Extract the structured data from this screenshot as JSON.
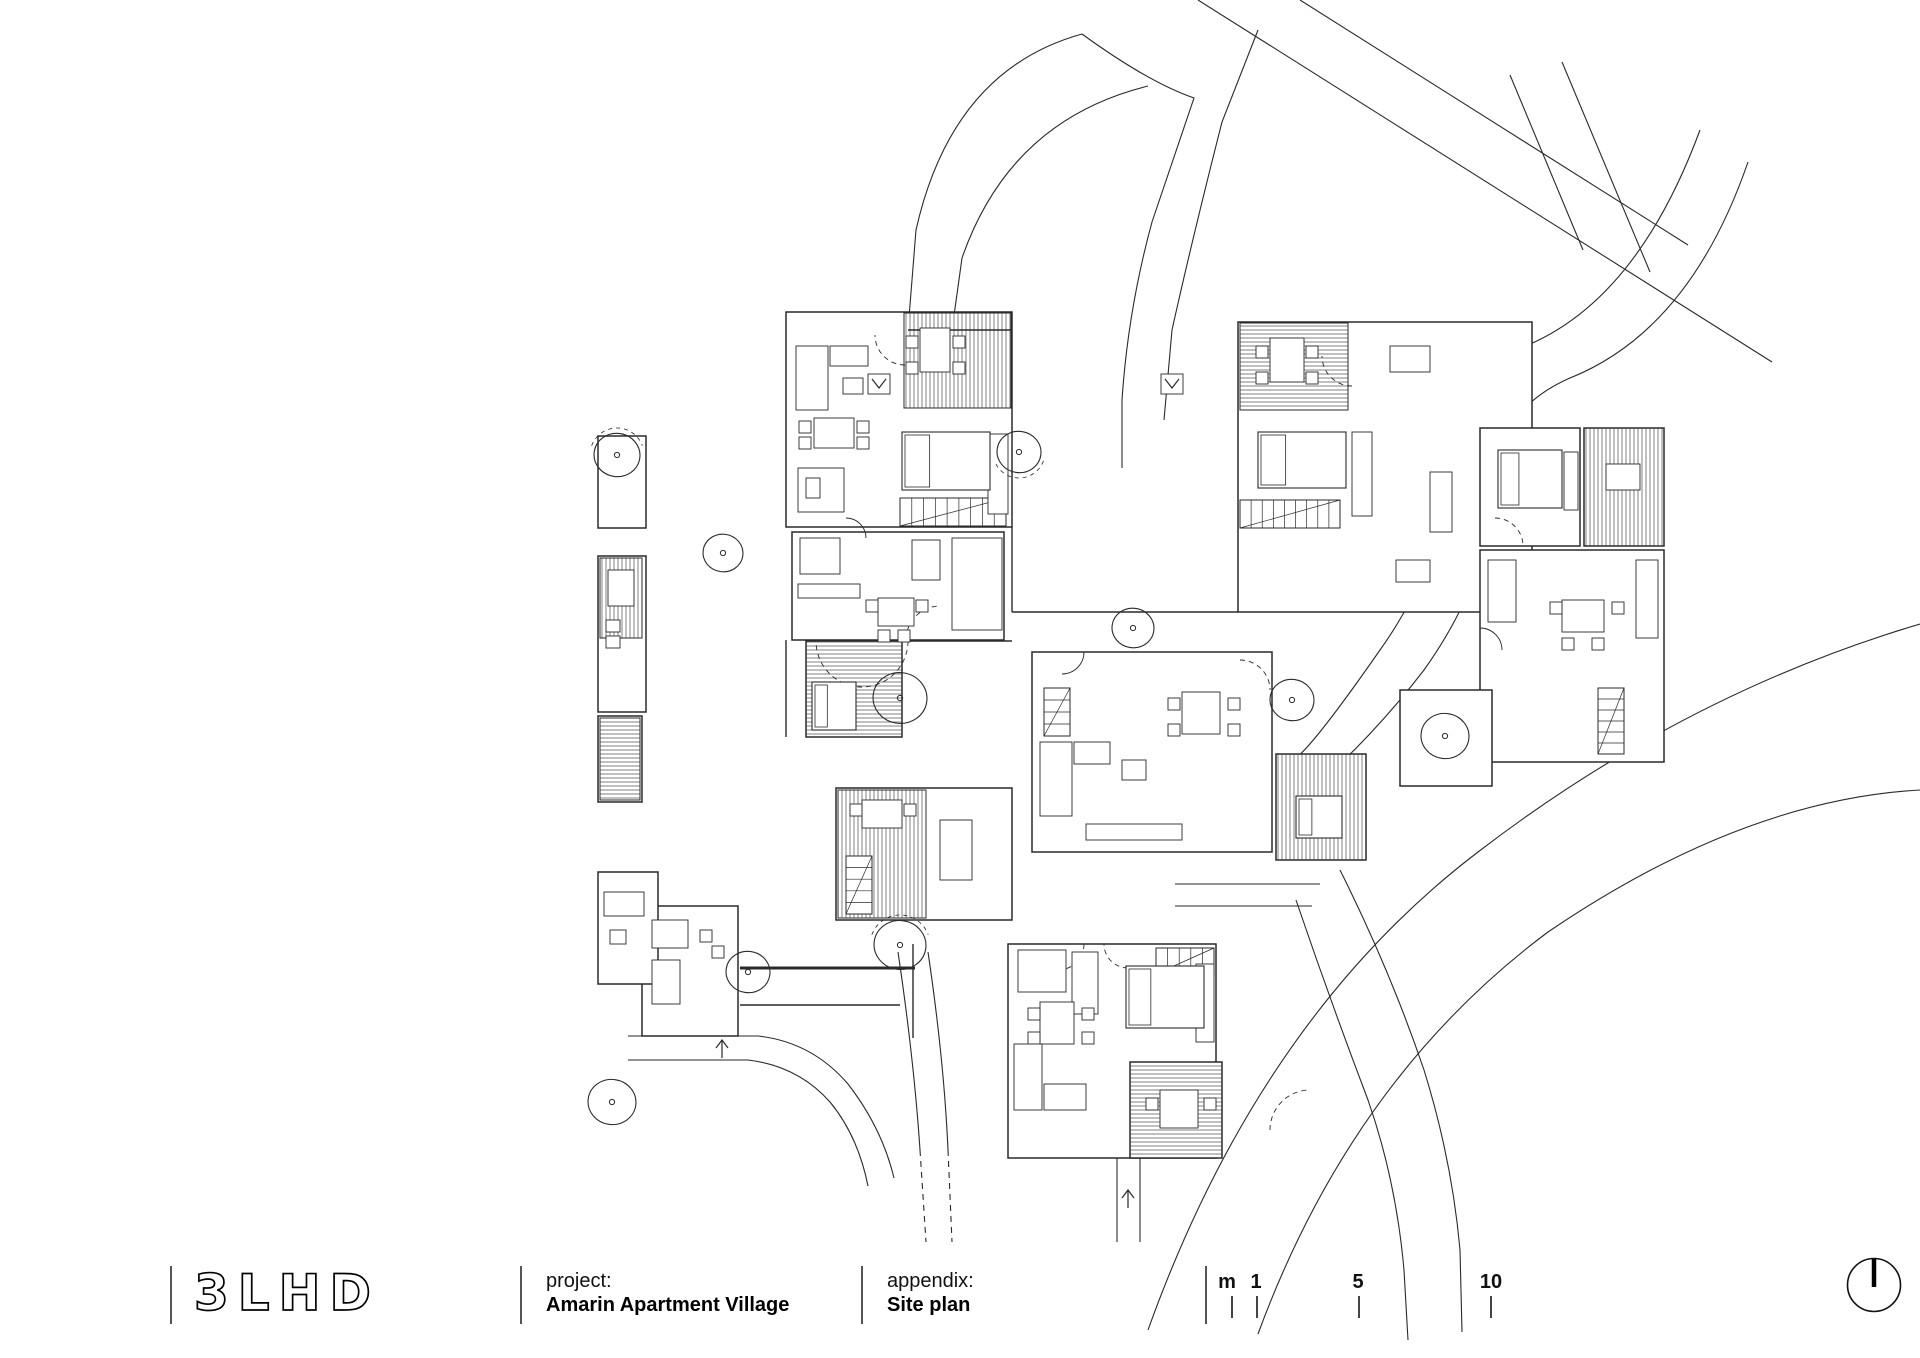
{
  "titlebar": {
    "logo_text": "3LHD",
    "project_label": "project:",
    "project_value": "Amarin Apartment Village",
    "appendix_label": "appendix:",
    "appendix_value": "Site plan",
    "scale_unit": "m",
    "scale_ticks": [
      "1",
      "5",
      "10"
    ]
  },
  "drawing": {
    "ink": "#2a2a2a",
    "roads": [
      {
        "d": "M 1082 34 Q 1148 82 1194 98 L 1152 222 Q 1128 310 1122 400 L 1122 468"
      },
      {
        "d": "M 1258 30 L 1222 122 Q 1192 240 1172 330 L 1164 420"
      },
      {
        "d": "M 1082 34 Q 952 70 916 230 L 908 330"
      },
      {
        "d": "M 1148 86 Q 1010 120 962 258 L 952 330"
      },
      {
        "d": "M 1198 0 L 1772 362"
      },
      {
        "d": "M 1300 0 L 1688 245"
      },
      {
        "d": "M 1510 75 L 1583 250"
      },
      {
        "d": "M 1562 62 L 1650 272"
      },
      {
        "d": "M 1700 130 Q 1638 298 1528 345 Q 1448 380 1446 470 Q 1444 560 1380 650 Q 1316 742 1296 758"
      },
      {
        "d": "M 1748 162 Q 1690 330 1570 378 Q 1492 412 1490 498 Q 1488 580 1424 670 Q 1384 722 1340 764 Q 1310 790 1296 816"
      },
      {
        "d": "M 1296 758 Q 1310 810 1318 860"
      },
      {
        "d": "M 1148 1330 Q 1260 1018 1478 852 Q 1684 694 1920 624"
      },
      {
        "d": "M 1258 1334 Q 1352 1078 1548 932 Q 1742 800 1920 790"
      },
      {
        "d": "M 1296 900 Q 1330 1000 1368 1100 Q 1396 1180 1404 1270 L 1408 1340"
      },
      {
        "d": "M 1340 870 Q 1390 970 1424 1070 Q 1452 1160 1460 1250 L 1462 1332"
      },
      {
        "d": "M 1175 884 L 1320 884"
      },
      {
        "d": "M 1175 906 L 1312 906"
      },
      {
        "d": "M 898 952 Q 914 1060 920 1150"
      },
      {
        "d": "M 920 1150 L 926 1242",
        "dash": true
      },
      {
        "d": "M 928 952 Q 944 1060 948 1150"
      },
      {
        "d": "M 948 1150 L 952 1242",
        "dash": true
      },
      {
        "d": "M 1117 1158 L 1117 1242"
      },
      {
        "d": "M 1140 1158 L 1140 1242"
      },
      {
        "d": "M 628 1036 L 758 1036 Q 812 1042 848 1084 Q 882 1128 894 1178"
      },
      {
        "d": "M 628 1060 L 748 1060 Q 798 1066 830 1102 Q 858 1136 868 1186"
      }
    ],
    "units": [
      [
        786,
        312,
        226,
        215
      ],
      [
        792,
        532,
        212,
        108
      ],
      [
        806,
        641,
        96,
        96
      ],
      [
        1238,
        322,
        294,
        290
      ],
      [
        1480,
        428,
        100,
        118
      ],
      [
        1584,
        428,
        80,
        118
      ],
      [
        1480,
        550,
        184,
        212
      ],
      [
        1032,
        652,
        240,
        200
      ],
      [
        1276,
        754,
        90,
        106
      ],
      [
        836,
        788,
        176,
        132
      ],
      [
        1008,
        944,
        208,
        214
      ],
      [
        1130,
        1062,
        92,
        96
      ],
      [
        642,
        906,
        96,
        130
      ],
      [
        598,
        436,
        48,
        92
      ],
      [
        598,
        556,
        48,
        156
      ],
      [
        598,
        716,
        44,
        86
      ],
      [
        598,
        872,
        60,
        112
      ],
      [
        1400,
        690,
        92,
        96
      ]
    ],
    "hatches": [
      [
        904,
        313,
        107,
        95,
        "v"
      ],
      [
        1240,
        323,
        108,
        87,
        "h"
      ],
      [
        806,
        641,
        96,
        96,
        "h"
      ],
      [
        1584,
        428,
        80,
        118,
        "v"
      ],
      [
        838,
        790,
        88,
        128,
        "v"
      ],
      [
        1276,
        754,
        90,
        106,
        "v"
      ],
      [
        1130,
        1062,
        92,
        96,
        "h"
      ],
      [
        600,
        558,
        42,
        80,
        "v"
      ],
      [
        600,
        718,
        40,
        82,
        "h"
      ]
    ],
    "walls": [
      [
        1012,
        527,
        1012,
        612,
        1.4
      ],
      [
        1012,
        612,
        1238,
        612,
        1.4
      ],
      [
        786,
        640,
        786,
        737,
        1.4
      ],
      [
        902,
        641,
        1012,
        641,
        1.4
      ],
      [
        908,
        330,
        1012,
        330,
        1.4
      ],
      [
        740,
        968,
        915,
        968,
        3
      ],
      [
        740,
        1005,
        900,
        1005,
        1.4
      ],
      [
        913,
        944,
        913,
        1038,
        1.4
      ]
    ],
    "furniture": [
      [
        796,
        346,
        32,
        64
      ],
      [
        830,
        346,
        38,
        20
      ],
      [
        843,
        378,
        20,
        16
      ],
      [
        814,
        418,
        40,
        30
      ],
      [
        799,
        421,
        12,
        12
      ],
      [
        799,
        437,
        12,
        12
      ],
      [
        857,
        421,
        12,
        12
      ],
      [
        857,
        437,
        12,
        12
      ],
      [
        920,
        328,
        30,
        44
      ],
      [
        906,
        336,
        12,
        12
      ],
      [
        953,
        336,
        12,
        12
      ],
      [
        906,
        362,
        12,
        12
      ],
      [
        953,
        362,
        12,
        12
      ],
      [
        988,
        434,
        20,
        80
      ],
      [
        798,
        468,
        46,
        44
      ],
      [
        806,
        478,
        14,
        20
      ],
      [
        800,
        538,
        40,
        36
      ],
      [
        798,
        584,
        62,
        14
      ],
      [
        878,
        598,
        36,
        28
      ],
      [
        866,
        600,
        12,
        12
      ],
      [
        916,
        600,
        12,
        12
      ],
      [
        878,
        630,
        12,
        12
      ],
      [
        898,
        630,
        12,
        12
      ],
      [
        912,
        540,
        28,
        40
      ],
      [
        952,
        538,
        50,
        92
      ],
      [
        862,
        800,
        40,
        28
      ],
      [
        850,
        804,
        12,
        12
      ],
      [
        904,
        804,
        12,
        12
      ],
      [
        940,
        820,
        32,
        60
      ],
      [
        1270,
        338,
        34,
        44
      ],
      [
        1256,
        346,
        12,
        12
      ],
      [
        1306,
        346,
        12,
        12
      ],
      [
        1256,
        372,
        12,
        12
      ],
      [
        1306,
        372,
        12,
        12
      ],
      [
        1352,
        432,
        20,
        84
      ],
      [
        1390,
        346,
        40,
        26
      ],
      [
        1430,
        472,
        22,
        60
      ],
      [
        1396,
        560,
        34,
        22
      ],
      [
        1606,
        464,
        34,
        26
      ],
      [
        1488,
        560,
        28,
        62
      ],
      [
        1562,
        600,
        42,
        32
      ],
      [
        1550,
        602,
        12,
        12
      ],
      [
        1612,
        602,
        12,
        12
      ],
      [
        1562,
        638,
        12,
        12
      ],
      [
        1592,
        638,
        12,
        12
      ],
      [
        1636,
        560,
        22,
        78
      ],
      [
        1564,
        452,
        14,
        58
      ],
      [
        1040,
        742,
        32,
        74
      ],
      [
        1074,
        742,
        36,
        22
      ],
      [
        1182,
        692,
        38,
        42
      ],
      [
        1168,
        698,
        12,
        12
      ],
      [
        1228,
        698,
        12,
        12
      ],
      [
        1168,
        724,
        12,
        12
      ],
      [
        1228,
        724,
        12,
        12
      ],
      [
        1086,
        824,
        96,
        16
      ],
      [
        1122,
        760,
        24,
        20
      ],
      [
        1018,
        950,
        48,
        42
      ],
      [
        1072,
        952,
        26,
        62
      ],
      [
        1040,
        1002,
        34,
        42
      ],
      [
        1028,
        1008,
        12,
        12
      ],
      [
        1082,
        1008,
        12,
        12
      ],
      [
        1028,
        1032,
        12,
        12
      ],
      [
        1082,
        1032,
        12,
        12
      ],
      [
        1014,
        1044,
        28,
        66
      ],
      [
        1044,
        1084,
        42,
        26
      ],
      [
        1196,
        964,
        18,
        78
      ],
      [
        1160,
        1090,
        38,
        38
      ],
      [
        1146,
        1098,
        12,
        12
      ],
      [
        1204,
        1098,
        12,
        12
      ],
      [
        652,
        920,
        36,
        28
      ],
      [
        652,
        960,
        28,
        44
      ],
      [
        700,
        930,
        12,
        12
      ],
      [
        712,
        946,
        12,
        12
      ],
      [
        608,
        570,
        26,
        36
      ],
      [
        606,
        620,
        14,
        12
      ],
      [
        606,
        636,
        14,
        12
      ],
      [
        604,
        892,
        40,
        24
      ],
      [
        610,
        930,
        16,
        14
      ],
      [
        868,
        374,
        22,
        20
      ],
      [
        1161,
        374,
        22,
        20
      ]
    ],
    "beds": [
      [
        902,
        432,
        88,
        58
      ],
      [
        1258,
        432,
        88,
        56
      ],
      [
        1498,
        450,
        64,
        58
      ],
      [
        1126,
        966,
        78,
        62
      ],
      [
        812,
        682,
        44,
        48
      ],
      [
        1296,
        796,
        46,
        42
      ]
    ],
    "stairs": [
      [
        900,
        498,
        106,
        28,
        "h"
      ],
      [
        1240,
        500,
        100,
        28,
        "h"
      ],
      [
        1598,
        688,
        26,
        66,
        "v"
      ],
      [
        1156,
        948,
        58,
        26,
        "h"
      ],
      [
        846,
        856,
        26,
        58,
        "v"
      ],
      [
        1044,
        688,
        26,
        48,
        "v"
      ]
    ],
    "trees": [
      [
        617,
        455,
        23
      ],
      [
        723,
        553,
        20
      ],
      [
        900,
        698,
        27
      ],
      [
        1019,
        452,
        22
      ],
      [
        1133,
        628,
        21
      ],
      [
        1292,
        700,
        22
      ],
      [
        1445,
        736,
        24
      ],
      [
        900,
        945,
        26
      ],
      [
        748,
        972,
        22
      ],
      [
        612,
        1102,
        24
      ]
    ],
    "arcs": [
      {
        "cx": 862,
        "cy": 641,
        "r": 46,
        "a0": 0,
        "a1": 180,
        "dash": true
      },
      {
        "cx": 905,
        "cy": 335,
        "r": 30,
        "a0": 90,
        "a1": 180,
        "dash": true
      },
      {
        "cx": 940,
        "cy": 640,
        "r": 34,
        "a0": 180,
        "a1": 270,
        "dash": true
      },
      {
        "cx": 1240,
        "cy": 690,
        "r": 30,
        "a0": 270,
        "a1": 360,
        "dash": true
      },
      {
        "cx": 1310,
        "cy": 1130,
        "r": 40,
        "a0": 180,
        "a1": 270,
        "dash": true
      },
      {
        "cx": 1058,
        "cy": 944,
        "r": 26,
        "a0": 0,
        "a1": 90,
        "dash": true
      },
      {
        "cx": 1495,
        "cy": 546,
        "r": 28,
        "a0": 270,
        "a1": 360,
        "dash": true
      },
      {
        "cx": 1352,
        "cy": 356,
        "r": 30,
        "a0": 90,
        "a1": 180,
        "dash": true
      },
      {
        "cx": 1128,
        "cy": 944,
        "r": 24,
        "a0": 90,
        "a1": 180,
        "dash": true
      },
      {
        "cx": 846,
        "cy": 538,
        "r": 20,
        "a0": 270,
        "a1": 360,
        "dash": false
      },
      {
        "cx": 1062,
        "cy": 652,
        "r": 22,
        "a0": 0,
        "a1": 90,
        "dash": false
      },
      {
        "cx": 1480,
        "cy": 650,
        "r": 22,
        "a0": 270,
        "a1": 360,
        "dash": false
      }
    ],
    "tree_arcs": [
      {
        "cx": 617,
        "cy": 455,
        "r": 27,
        "a0": 200,
        "a1": 340
      },
      {
        "cx": 1019,
        "cy": 452,
        "r": 26,
        "a0": 20,
        "a1": 160
      },
      {
        "cx": 900,
        "cy": 945,
        "r": 30,
        "a0": 200,
        "a1": 340
      }
    ],
    "arrows": [
      {
        "x": 879,
        "y": 384,
        "dir": "down"
      },
      {
        "x": 1172,
        "y": 384,
        "dir": "down"
      },
      {
        "x": 1128,
        "y": 1192,
        "dir": "up"
      },
      {
        "x": 722,
        "y": 1042,
        "dir": "up"
      }
    ]
  }
}
